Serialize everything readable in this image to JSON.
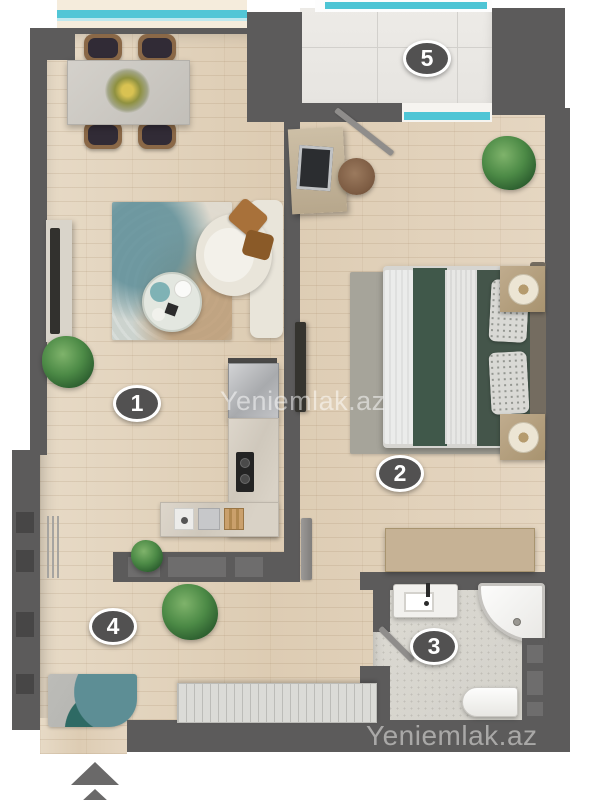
{
  "floorplan": {
    "badges": [
      {
        "label": "1"
      },
      {
        "label": "2"
      },
      {
        "label": "3"
      },
      {
        "label": "4"
      },
      {
        "label": "5"
      }
    ],
    "watermarks": {
      "center": "Yeniemlak.az",
      "bottom": "Yeniemlak.az"
    },
    "colors": {
      "wall": "#5c5b5b",
      "accent_teal": "#4ec5d5",
      "badge_fill": "#525151",
      "wood_floor": "#e3d5c0",
      "balcony_tile": "#eae8e4",
      "bathroom_tile": "#d9d7d0",
      "bed_green": "#40584a",
      "arrow_gray": "#6a6969"
    }
  }
}
